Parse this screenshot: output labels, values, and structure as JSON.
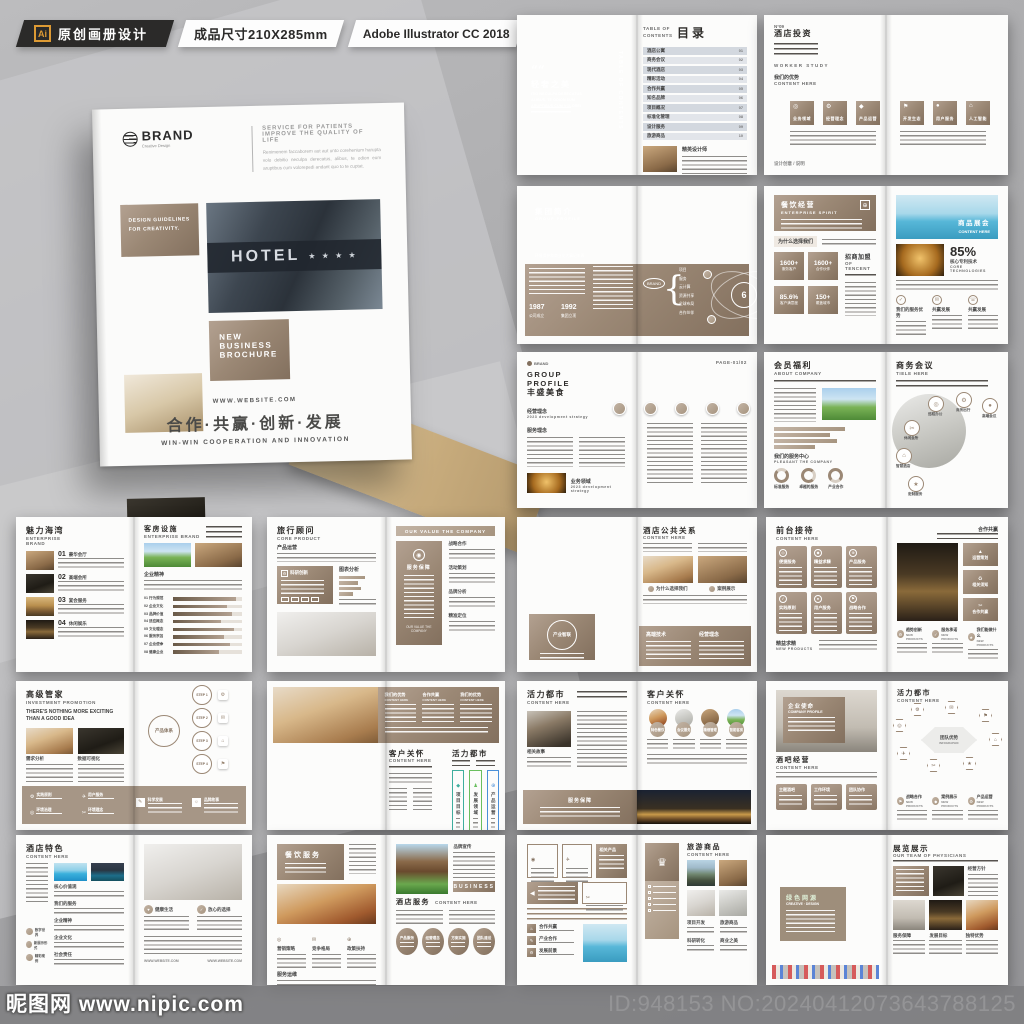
{
  "top_bar": {
    "ai_badge": "Ai",
    "category_label": "原创画册设计",
    "size_label": "成品尺寸210X285mm",
    "software_label": "Adobe Illustrator CC 2018"
  },
  "colors": {
    "taupe": "#9b8875",
    "taupe_dark": "#83705e",
    "accent_orange": "#dd9a34"
  },
  "cover": {
    "brand": "BRAND",
    "brand_sub": "Creative Design",
    "tagline_line1": "SERVICE FOR PATIENTS",
    "tagline_line2": "IMPROVE THE QUALITY OF LIFE",
    "intro_text": "Renimenem faccaborem aut aut unto corehenium harupta volo debitio neculpa derecatus, alibus, te odion eum aruptibus cum volorepedi andant quo to te cuptat.",
    "guidelines_label": "DESIGN GUIDELINES FOR CREATIVITY.",
    "hotel_sign": "HOTEL",
    "hotel_stars": "★ ★ ★ ★",
    "badge_line1": "NEW",
    "badge_line2": "BUSINESS",
    "badge_line3": "BROCHURE",
    "website": "WWW.WEBSITE.COM",
    "slogan_cn": "合作·共赢·创新·发展",
    "slogan_en": "WIN-WIN COOPERATION AND INNOVATION"
  },
  "spreads": [
    {
      "name": "目录",
      "left_quote_title": "轻奢之美",
      "left_quote_sub": "ITIO NECULPA DERECATUS ALIBUS, TE ODION EUM ARUPTIBUS CUM VOLOREI",
      "side_vertical": "TABLE OF CONTENTS",
      "toc_label": "TABLE OF CONTENTS",
      "toc_title": "目录",
      "items": [
        "酒店公寓",
        "商务会议",
        "现代酒店",
        "精彩活动",
        "合作共赢",
        "知名品牌",
        "项目概况",
        "标准化管理",
        "设计服务",
        "旅游商品"
      ],
      "page_nums": [
        "01",
        "02",
        "03",
        "04",
        "05",
        "06",
        "07",
        "08",
        "09",
        "10"
      ],
      "bottom_caption": "精英设计师"
    },
    {
      "name": "酒店投资",
      "no": "N°09",
      "title": "酒店投资",
      "worker_label": "WORKER STUDY",
      "advantage_title": "我们的优势",
      "advantage_sub": "CONTENT HERE",
      "tiles": [
        "业务领域",
        "经营理念",
        "产品运营",
        "开发生态",
        "用户服务",
        "人工智能"
      ],
      "footer_note": "设计创意 / 说明"
    },
    {
      "name": "集团简介",
      "title": "集团简介",
      "sub": "GROUP PROFILE",
      "caption": "环境保护和商业化大事记年表",
      "year1": "1987",
      "year1_label": "公司成立",
      "year2": "1992",
      "year2_label": "集团立项",
      "center": "6",
      "center_sub": "大事记年表",
      "bracket_label": "BRAND",
      "items": [
        "项目",
        "服务",
        "云计算",
        "资源共享",
        "全球布局",
        "合作伙伴"
      ]
    },
    {
      "name": "餐饮经营",
      "title": "餐饮经营",
      "sub": "ENTERPRISE SPIRIT",
      "why_label": "为什么选择我们",
      "stats": [
        "1600+",
        "1600+",
        "85.6%",
        "150+"
      ],
      "stat_labels": [
        "服务客户",
        "合作伙伴",
        "客户满意度",
        "覆盖城市"
      ],
      "join_title": "招商加盟",
      "join_sub": "OF TENCENT",
      "banner_title": "商品展会",
      "banner_sub": "CONTENT HERE",
      "percent": "85%",
      "percent_label": "核心专利技术",
      "percent_sub": "CORE TECHNOLOGIES",
      "cols": [
        "我们的服务优势",
        "共赢发展",
        "共赢发展"
      ]
    },
    {
      "name": "丰盛美食",
      "page_label": "PAGE-01/02",
      "brand": "BRAND",
      "title_en": "GROUP PROFILE",
      "title": "丰盛美食",
      "sec1": "经营理念",
      "sec1_sub": "2023 development strategy",
      "sec2": "服务理念",
      "sec3": "业务领域",
      "sec3_sub": "2023 development strategy"
    },
    {
      "name": "会员福利",
      "left_title": "会员福利",
      "left_sub": "ABOUT COMPANY",
      "left_caption": "我们的服务中心",
      "left_caption_sub": "PLEASANT THE COMPANY",
      "donut_labels": [
        "标准服务",
        "卓越的服务",
        "产业合作"
      ],
      "right_title": "商务会议",
      "right_sub": "TIELE HERE",
      "satellites": [
        "远程办公",
        "商务出行",
        "高端会议",
        "休闲会所",
        "智慧酒店",
        "定制服务"
      ]
    },
    {
      "name": "魅力海湾",
      "left_title": "魅力海湾",
      "left_sub1": "ENTERPRISE",
      "left_sub2": "BRAND",
      "item_nums": [
        "01",
        "02",
        "03",
        "04"
      ],
      "item_labels": [
        "豪华会厅",
        "高端会所",
        "宴会服务",
        "休闲娱乐"
      ],
      "right_title": "客房设施",
      "right_sub": "ENTERPRISE BRAND",
      "spirit_label": "企业精神",
      "spirit_sub": "ENTERPRISE BRAND",
      "bar_labels": [
        "01 行为规范",
        "02 企业文化",
        "03 品牌价值",
        "04 适应概念",
        "05 文化理念",
        "06 服务宗旨",
        "07 企业使命",
        "08 健康企业"
      ],
      "bar_values": [
        92,
        78,
        85,
        70,
        88,
        74,
        82,
        66
      ]
    },
    {
      "name": "旅行顾问",
      "left_title": "旅行顾问",
      "left_sub": "CORE PRODUCT",
      "left_caption": "产品运营",
      "box1_title": "科研创新",
      "box2_title": "图表分析",
      "banner": "OUR VALUE THE COMPANY",
      "panel_title": "服务保障",
      "panel_footer": "OUR VALUE THE COMPANY",
      "sections": [
        "战略合作",
        "活动策划",
        "品牌分析",
        "精准定位"
      ]
    },
    {
      "name": "酒店公共关系",
      "circle_label": "产业智联",
      "right_title": "酒店公共关系",
      "right_sub": "CONTENT HERE",
      "captions": [
        "为什么选择我们",
        "案例展示"
      ],
      "panel_cols": [
        "高端技术",
        "经营理念"
      ]
    },
    {
      "name": "前台接待",
      "left_title": "前台接待",
      "left_sub": "CONTENT HERE",
      "cards": [
        "便捷服务",
        "精益求精",
        "产品服务",
        "实践原则",
        "用户服务",
        "战略合作"
      ],
      "left_footer": "精益求精",
      "left_footer_sub": "NEW PRODUCTS",
      "right_top": "合作共赢",
      "right_tiles": [
        "运营策划",
        "相关须知",
        "合作共赢"
      ],
      "right_cols": [
        "趋势创新",
        "服务承诺",
        "我们能做什么"
      ],
      "right_cols_sub": "NEW PRODUCTS"
    },
    {
      "name": "高级管家",
      "left_title": "高级管家",
      "left_sub": "INVESTMENT PROMOTION",
      "headline": "THERE'S NOTHING MORE EXCITING THAN A GOOD IDEA",
      "captions": [
        "需求分析",
        "数据可视化"
      ],
      "center_label": "产品体系",
      "steps": [
        "STEP 1",
        "STEP 2",
        "STEP 3",
        "STEP 4"
      ],
      "band_items": [
        "实践原则",
        "用户服务",
        "环境治理",
        "环境理念"
      ],
      "band_right": [
        "科学发展",
        "品牌故事"
      ]
    },
    {
      "name": "客户关怀",
      "panel_titles": [
        "我们的优势",
        "合作共赢",
        "我们的优势"
      ],
      "panel_sub": "CONTENT HERE",
      "left_title": "客户关怀",
      "left_sub": "CONTENT HERE",
      "right_title": "活力都市",
      "boxes": [
        "项目目标",
        "发展领域",
        "产品运营"
      ],
      "box_colors": [
        "#3fae9e",
        "#6abf5e",
        "#4a90d9"
      ]
    },
    {
      "name": "活力都市",
      "left_title": "活力都市",
      "left_sub": "CONTENT HERE",
      "left_caption": "相关故事",
      "right_title": "客户关怀",
      "right_sub": "CONTENT HERE",
      "circle_labels": [
        "特色餐饮",
        "会议服务",
        "精细管理",
        "智能客房"
      ],
      "band_title": "服务保障"
    },
    {
      "name": "企业使命",
      "overlay_title": "企业使命",
      "overlay_sub": "COMPANY PROFILE",
      "left_title": "酒吧经营",
      "left_sub": "CONTENT HERE",
      "card_labels": [
        "主题酒吧",
        "工作环境",
        "团队协作"
      ],
      "right_title": "活力都市",
      "right_sub": "CONTENT HERE",
      "hex_center": "团队优势",
      "hex_center_sub": "INFOGRAPHIC",
      "bottom_cols": [
        "战略合作",
        "案例展示",
        "产品运营"
      ],
      "bottom_sub": "NEW PRODUCTS"
    },
    {
      "name": "酒店特色",
      "left_title": "酒店特色",
      "left_sub": "CONTENT HERE",
      "sections": [
        "核心价值观",
        "我们的服务",
        "企业精神",
        "企业文化",
        "社会责任"
      ],
      "side_circles": [
        "数字世界",
        "新展示形式",
        "精彩案例"
      ],
      "right_cols": [
        "健康生活",
        "放心的选择"
      ],
      "website": "WWW.WEBSITE.COM"
    },
    {
      "name": "餐饮服务",
      "header_title": "餐饮服务",
      "cols": [
        "营销策略",
        "竞争格局",
        "政策扶持"
      ],
      "sec_title": "服务运维",
      "side_title": "品牌宣传",
      "button_label": "BUSINESS",
      "right_title": "酒店服务",
      "right_sub": "CONTENT HERE",
      "circle_labels": [
        "产品服务",
        "经营理念",
        "方案实施",
        "团队建设"
      ]
    },
    {
      "name": "旅游商品",
      "taupe_card": "相关产品",
      "list_items": [
        "合作共赢",
        "产业合作",
        "发展前景"
      ],
      "right_title": "旅游商品",
      "right_sub": "CONTENT HERE",
      "captions": [
        "项目开发",
        "旅游商品",
        "科研转化",
        "商业之美"
      ]
    },
    {
      "name": "展览展示",
      "overlay_title": "绿色网源",
      "overlay_sub": "CREATIVE · DESIGN",
      "right_title": "展览展示",
      "right_sub": "OUR TEAM OF PHYSICIANS",
      "captions": [
        "经营方针",
        "服务保障",
        "发展目标",
        "独特优势"
      ]
    }
  ],
  "footer": {
    "site_name": "昵图网",
    "site_url": "www.nipic.com",
    "watermark": "昵图网 www.nipic.com",
    "id_number": "ID:948153 NO:20240412073643788125"
  }
}
